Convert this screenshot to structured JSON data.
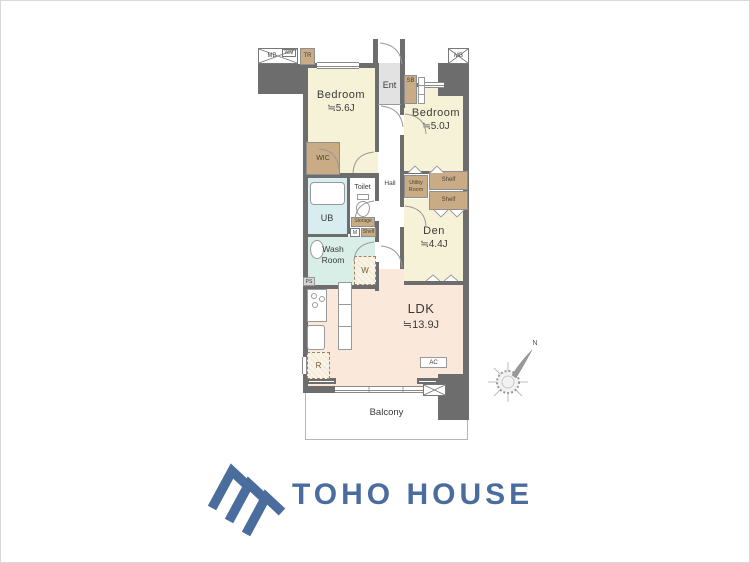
{
  "plan": {
    "rooms": {
      "bedroom1": {
        "name": "Bedroom",
        "size": "≒5.6J"
      },
      "bedroom2": {
        "name": "Bedroom",
        "size": "≒5.0J"
      },
      "den": {
        "name": "Den",
        "size": "≒4.4J"
      },
      "ldk": {
        "name": "LDK",
        "size": "≒13.9J"
      },
      "wic": "WIC",
      "ent": "Ent",
      "hall": "Hall",
      "toilet": "Toilet",
      "ub": "UB",
      "washroom": "Wash Room",
      "balcony": "Balcony"
    },
    "fixtures": {
      "mb": "MB",
      "wm": "WM",
      "tr": "TR",
      "sb": "SB",
      "storage": "Storage",
      "shelf": "Shelf",
      "meter": "M",
      "utility": "Utility Room",
      "washer": "W",
      "fridge": "R",
      "ac": "AC",
      "ps": "PS"
    },
    "compass": {
      "north": "N"
    },
    "colors": {
      "wall": "#6d6d6d",
      "room_cream": "#f6f2d8",
      "room_peach": "#fae8da",
      "bath_blue": "#d7edf0",
      "wash_teal": "#d9eee7",
      "closet_tan": "#c9ac85",
      "entrance_gray": "#e2e2e2",
      "logo_blue": "#4a6d9e"
    }
  },
  "logo": {
    "text": "TOHO HOUSE"
  }
}
